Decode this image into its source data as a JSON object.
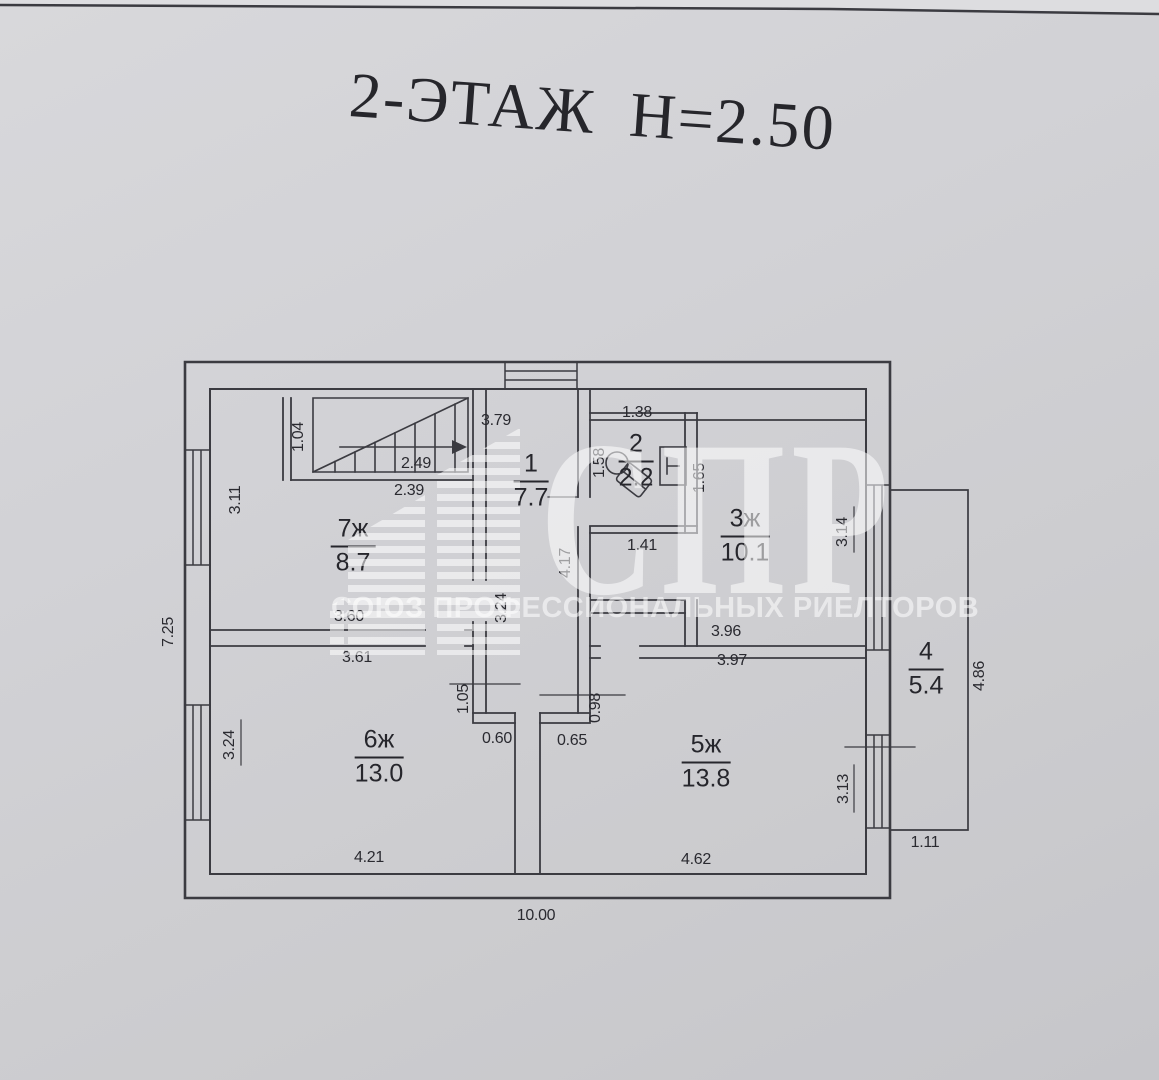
{
  "title": "2-ЭТАЖ Н=2.50",
  "floor_plan": {
    "rooms": [
      {
        "number": "1",
        "area": "7.7"
      },
      {
        "number": "2",
        "area": "2.2"
      },
      {
        "number": "3ж",
        "area": "10.1"
      },
      {
        "number": "4",
        "area": "5.4"
      },
      {
        "number": "5ж",
        "area": "13.8"
      },
      {
        "number": "6ж",
        "area": "13.0"
      },
      {
        "number": "7ж",
        "area": "8.7"
      }
    ],
    "dims": {
      "stairs_width": "1.04",
      "stairs_top": "3.79",
      "stairs_run": "2.49",
      "stairs_length": "2.39",
      "room7_left": "3.11",
      "left_total": "7.25",
      "room7_bottom": "3.60",
      "room7_door": "3.24",
      "hall_height": "4.17",
      "room2_top": "1.38",
      "room2_left": "1.58",
      "room2_right": "1.65",
      "room2_bottom": "1.41",
      "room3_right": "3.14",
      "room3_bottom": "3.96",
      "room6_top": "3.61",
      "room5_top": "3.97",
      "vestibule_left": "1.05",
      "vestibule_right": "0.98",
      "stub_left": "0.60",
      "stub_right": "0.65",
      "room6_left": "3.24",
      "room5_right": "3.13",
      "balcony_bottom": "1.11",
      "balcony_right": "4.86",
      "room6_bottom": "4.21",
      "room5_bottom": "4.62",
      "total_width": "10.00"
    }
  },
  "watermark": {
    "logo_text": "СПР",
    "subtitle": "СОЮЗ ПРОФЕССИОНАЛЬНЫХ РИЕЛТОРОВ"
  }
}
